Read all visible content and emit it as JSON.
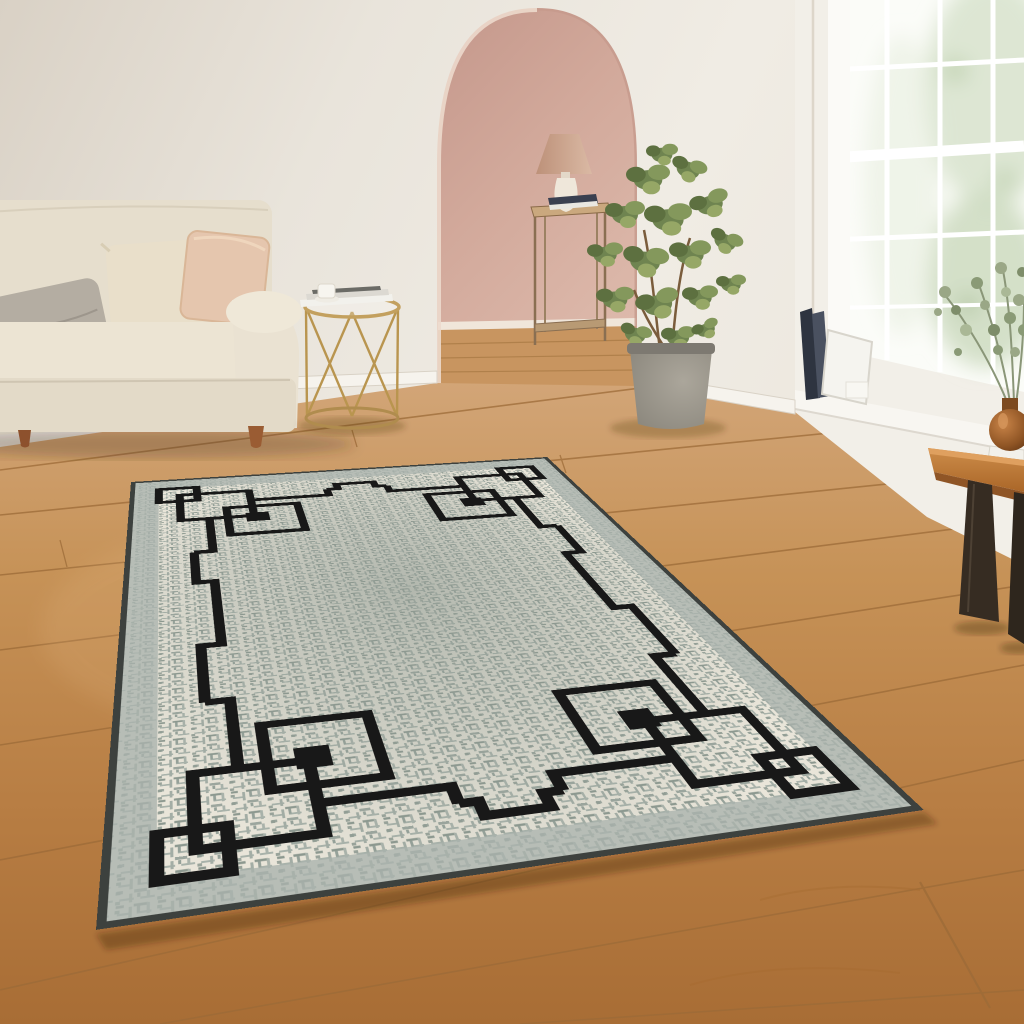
{
  "image_type": "interior product photograph, no visible text",
  "visible_text": [],
  "scene": {
    "description": "Bright living room with wooden plank floor. A grey flat-weave area rug with a black interlocking-squares border lies diagonally in the foreground. Cream sofa with three cushions at left, gold wire side table with magazines, pink arched doorway with console table and lamp in the center background, potted ficus plant, large white sash windows on the right with leaning books, and a wooden bench holding an amber vase of eucalyptus.",
    "objects": [
      {
        "name": "area-rug",
        "detail": "grey tweed field, cream margin, black geometric border with interlocking square corner motifs, sage-grey outer band, dark edge binding"
      },
      {
        "name": "sofa",
        "detail": "cream fabric, rolled arm, turned wood legs"
      },
      {
        "name": "pillow-gray",
        "detail": "taupe-grey cushion"
      },
      {
        "name": "pillow-cream",
        "detail": "cream cushion"
      },
      {
        "name": "pillow-blush",
        "detail": "blush pink cushion with piping"
      },
      {
        "name": "side-table",
        "detail": "gold wire frame round table with magazines and white cup"
      },
      {
        "name": "arched-doorway",
        "detail": "blush pink hallway, console table, lamp with tan shade, white vase"
      },
      {
        "name": "potted-plant",
        "detail": "variegated ficus in grey concrete pot"
      },
      {
        "name": "window",
        "detail": "white sash windows, white muntin grid, green foliage outside"
      },
      {
        "name": "windowsill-books",
        "detail": "dark books and white canvas leaning, small white candle"
      },
      {
        "name": "bench",
        "detail": "orange-brown wood top, dark angled steel legs, white book, amber glass vase with eucalyptus"
      }
    ]
  },
  "rug_pattern": {
    "field": "crosshatch tweed, grey center fading to cream edges",
    "border": "single black line with mid-side step jogs",
    "corners": "three overlapping outline squares plus one solid square at each corner"
  },
  "colors": {
    "wall": "#ece7df",
    "wallShade": "#d9d1c5",
    "archPink": "#d2a99b",
    "floorMid": "#c08a54",
    "seam": "#9c6b38",
    "baseboard": "#f6f3ed",
    "sofa": "#e9e1d1",
    "pillowGray": "#b4ada2",
    "pillowCream": "#e9dfca",
    "pillowBlush": "#e5c6ae",
    "legWood": "#9a5c33",
    "tableGold": "#bd9752",
    "rugBand": "#a9b2ac",
    "rugField": "#e9e5d9",
    "rugLine": "#181818",
    "rugTrim": "#3d413e",
    "plantGreen": "#6f8450",
    "pot": "#97938a",
    "windowWall": "#f2efe8",
    "glass": "#fbfcf8",
    "bench": "#b97937",
    "benchLeg": "#362c22",
    "vaseAmber": "#9a5f2a",
    "lampShade": "#c99e88",
    "consoleWood": "#8a6f52"
  }
}
